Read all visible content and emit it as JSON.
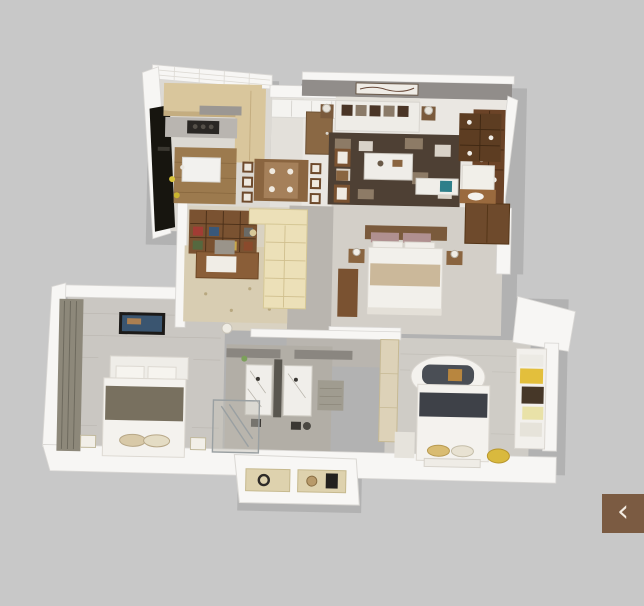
{
  "scene": {
    "description": "3D isometric render of a three-bedroom apartment floor plan on a gray backdrop",
    "background_color": "#c8c8c8"
  },
  "palette": {
    "background": "#c8c8c8",
    "wall_white": "#f7f6f4",
    "wall_gray_accent": "#918d8a",
    "feature_panel_black": "#17150f",
    "wood_dark": "#6b4327",
    "wood_medium": "#8a6540",
    "cabinet_tan": "#d9c69c",
    "floor_tile": "#dcd9d3",
    "floor_plank_gray": "#cac7c2",
    "corridor_tile": "#b9b5af",
    "rug_dark_marble": "#4e4034",
    "rug_beige": "#d8cdb2",
    "accent_teal": "#2e7f8a",
    "accent_yellow": "#e3bf3c",
    "bedding_white": "#f2f0eb",
    "headboard_charcoal": "#4a4e55",
    "nav_button_brown": "#7b5b42",
    "nav_icon_ivory": "#f3ece2"
  },
  "rooms": [
    {
      "id": "kitchen",
      "label": "Kitchen",
      "furniture": [
        "tan upper cabinets",
        "cooktop counter",
        "white island",
        "black feature wall",
        "white brick wall"
      ]
    },
    {
      "id": "dining",
      "label": "Dining area",
      "furniture": [
        "white sideboard",
        "wood dining table",
        "six chairs"
      ]
    },
    {
      "id": "living",
      "label": "Living room",
      "furniture": [
        "entry door",
        "wall art",
        "white sofa with brown pillows",
        "lamp side tables",
        "dark marble rug",
        "coffee table",
        "wood armchairs",
        "bench with teal pillow",
        "wood display cabinet"
      ]
    },
    {
      "id": "study",
      "label": "Study / library",
      "furniture": [
        "bookshelf wall",
        "cream corner shelving",
        "writing desk",
        "chair",
        "beige floral rug"
      ]
    },
    {
      "id": "master-bedroom",
      "label": "Master bedroom",
      "furniture": [
        "double bed with brown headboard",
        "two nightstands with lamps",
        "dark wood wardrobe",
        "tall cabinet",
        "display niche shelf",
        "bench",
        "wood vanity"
      ]
    },
    {
      "id": "bedroom-2",
      "label": "Bedroom 2",
      "furniture": [
        "double bed with gray-brown throw",
        "wall TV",
        "window curtains",
        "bedside stools"
      ]
    },
    {
      "id": "bathroom",
      "label": "Bathroom",
      "furniture": [
        "twin marble vanities",
        "dark partition",
        "glass shower",
        "bath rug"
      ]
    },
    {
      "id": "bedroom-3",
      "label": "Bedroom 3",
      "furniture": [
        "bed with oval headboard surround",
        "navy throw band",
        "window seat with yellow pillows",
        "light wood closet",
        "yellow pouf",
        "foot bench"
      ]
    },
    {
      "id": "display-niche",
      "label": "Front display niche",
      "furniture": [
        "two open shelves with decor objects"
      ]
    }
  ],
  "nav": {
    "prev_icon": "‹"
  }
}
